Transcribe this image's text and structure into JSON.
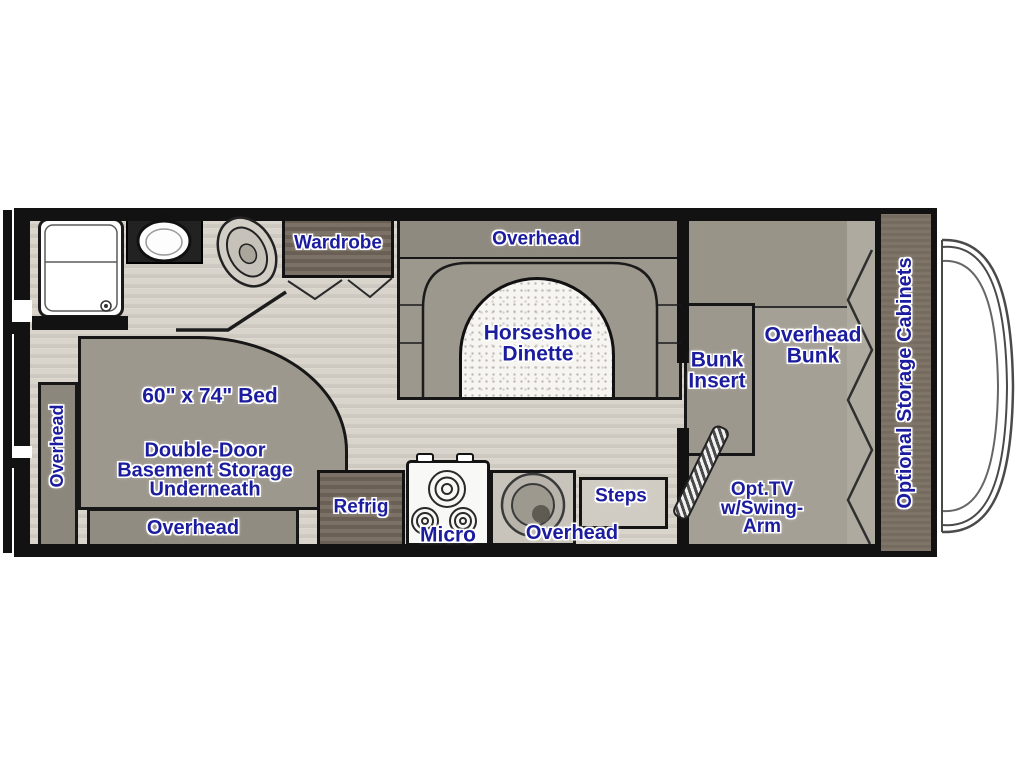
{
  "colors": {
    "label_blue": "#1c1c9e",
    "wall_black": "#121212",
    "furniture_gray": "#9d988e",
    "furniture_dark": "#908b81",
    "cabinet_dark": "#6f655a",
    "floor_light": "#d8d4cc",
    "bunk_floor": "#a5a096",
    "table_white": "#f6f5f2"
  },
  "labels": {
    "wardrobe": "Wardrobe",
    "dinette_overhead": "Overhead",
    "dinette": "Horseshoe\nDinette",
    "bunk_insert": "Bunk\nInsert",
    "overhead_bunk": "Overhead\nBunk",
    "optional_storage": "Optional Storage Cabinets",
    "bed_size": "60\" x 74\" Bed",
    "basement_storage": "Double-Door\nBasement Storage\nUnderneath",
    "bed_overhead_bottom": "Overhead",
    "bed_overhead_side": "Overhead",
    "refrig": "Refrig",
    "micro": "Micro",
    "kitchen_overhead": "Overhead",
    "steps": "Steps",
    "opt_tv": "Opt.TV\nw/Swing-\nArm"
  },
  "fixtures": {
    "icons": [
      "shower-icon",
      "bathroom-sink-icon",
      "toilet-icon",
      "stove-burners-icon",
      "kitchen-sink-icon",
      "entry-door-icon",
      "bunk-fold-icon",
      "cab-windshield-icon"
    ]
  }
}
